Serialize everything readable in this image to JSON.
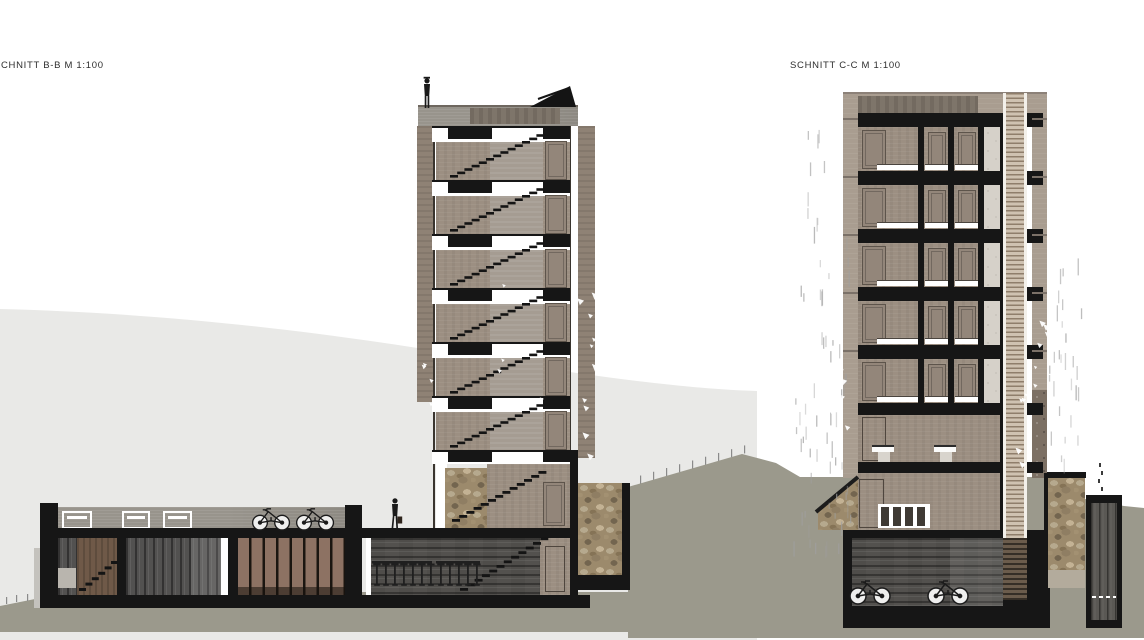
{
  "title_labels": {
    "left": "CHNITT B-B M 1:100",
    "right": "SCHNITT C-C M 1:100"
  },
  "sections": {
    "left": {
      "name": "Schnitt B-B",
      "scale": "M 1:100",
      "tower_typical_floors": 6,
      "people": [
        "person-on-tower-roof",
        "person-on-walkway-with-bag"
      ],
      "bicycles_on_roof": 2,
      "basement_rooms": [
        "stair-room",
        "storage-room",
        "locker-room",
        "bar-room"
      ],
      "bar_stool_posts": 12
    },
    "right": {
      "name": "Schnitt C-C",
      "scale": "M 1:100",
      "typical_floors": 5,
      "rooms_per_floor": 3,
      "washroom_toilets": 2,
      "basement_bicycles": 2
    }
  },
  "colors": {
    "paper": "#ffffff",
    "ink": "#161616",
    "hill": "#e9e9e7",
    "terrain": "#9b998c",
    "wall": "#9c8f82",
    "wallLight": "#a99d90",
    "strip": "#a59c92",
    "door": "#93867a",
    "doorLine": "#5d544b",
    "roofband": "#98948c",
    "screen": "#8f8275",
    "stoneBase": "#9c8a6c",
    "shaft": "#cfc2b1",
    "rain": "#a8a8a8"
  }
}
